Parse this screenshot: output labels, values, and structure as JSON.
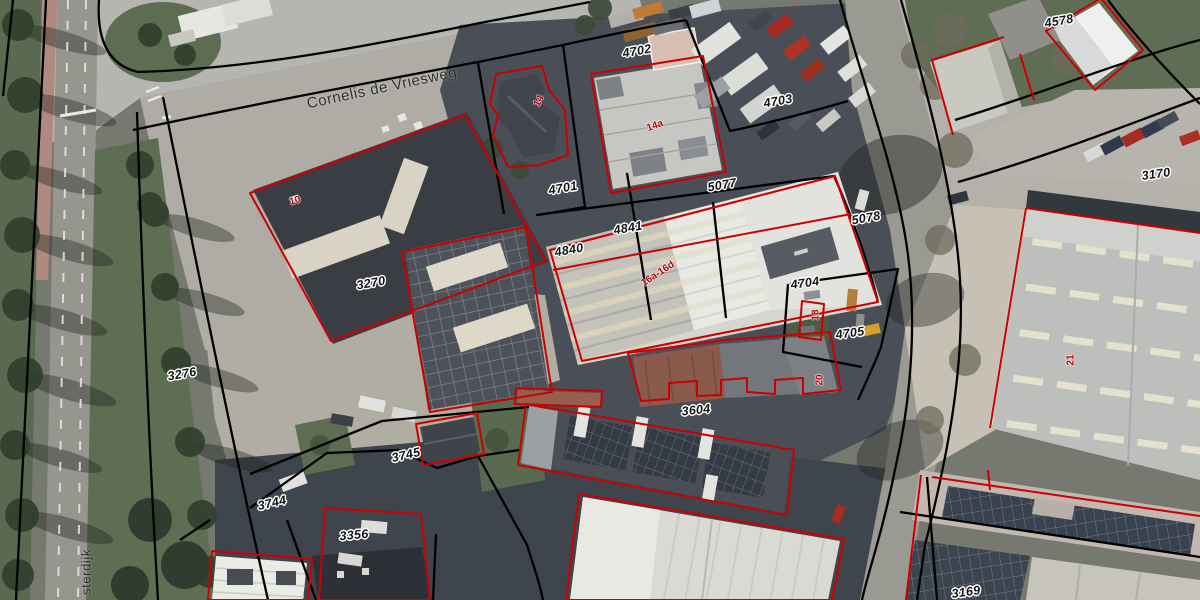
{
  "map": {
    "description": "Aerial photograph with cadastral parcel boundaries and building outlines",
    "colors": {
      "parcel_boundary": "#000000",
      "building_outline": "#cd0000",
      "parcel_label_text": "#141414",
      "parcel_label_halo": "#ffffff",
      "house_number_text": "#b40000",
      "street_label_text": "#2e2e2e"
    },
    "street_labels": [
      {
        "text": "Cornelis de Vriesweg",
        "x": 382,
        "y": 88,
        "rotation": -12,
        "size": 15
      },
      {
        "text": "sterdijk",
        "x": 86,
        "y": 572,
        "rotation": -90,
        "size": 13
      }
    ],
    "parcel_labels": [
      {
        "text": "4702",
        "x": 637,
        "y": 51,
        "rotation": -10
      },
      {
        "text": "4703",
        "x": 778,
        "y": 101,
        "rotation": -10
      },
      {
        "text": "4701",
        "x": 563,
        "y": 188,
        "rotation": -10
      },
      {
        "text": "5077",
        "x": 722,
        "y": 185,
        "rotation": -10
      },
      {
        "text": "5078",
        "x": 866,
        "y": 218,
        "rotation": -10
      },
      {
        "text": "4841",
        "x": 628,
        "y": 228,
        "rotation": -10
      },
      {
        "text": "4840",
        "x": 569,
        "y": 250,
        "rotation": -10
      },
      {
        "text": "4704",
        "x": 805,
        "y": 283,
        "rotation": -8
      },
      {
        "text": "4705",
        "x": 850,
        "y": 333,
        "rotation": -8
      },
      {
        "text": "3604",
        "x": 696,
        "y": 410,
        "rotation": -6
      },
      {
        "text": "3270",
        "x": 371,
        "y": 283,
        "rotation": -10
      },
      {
        "text": "3276",
        "x": 182,
        "y": 374,
        "rotation": -10
      },
      {
        "text": "3745",
        "x": 406,
        "y": 455,
        "rotation": -13
      },
      {
        "text": "3744",
        "x": 272,
        "y": 503,
        "rotation": -13
      },
      {
        "text": "3356",
        "x": 354,
        "y": 535,
        "rotation": -5
      },
      {
        "text": "3170",
        "x": 1156,
        "y": 174,
        "rotation": -8
      },
      {
        "text": "4578",
        "x": 1059,
        "y": 21,
        "rotation": -10
      },
      {
        "text": "3169",
        "x": 966,
        "y": 592,
        "rotation": -8
      }
    ],
    "house_number_labels": [
      {
        "text": "14",
        "x": 539,
        "y": 101,
        "rotation": -62
      },
      {
        "text": "14a",
        "x": 655,
        "y": 126,
        "rotation": -20
      },
      {
        "text": "16a-16d",
        "x": 658,
        "y": 274,
        "rotation": -33
      },
      {
        "text": "18",
        "x": 816,
        "y": 315,
        "rotation": -90
      },
      {
        "text": "20",
        "x": 820,
        "y": 380,
        "rotation": -88
      },
      {
        "text": "10",
        "x": 295,
        "y": 201,
        "rotation": -15
      },
      {
        "text": "21",
        "x": 1071,
        "y": 360,
        "rotation": -90
      }
    ]
  }
}
